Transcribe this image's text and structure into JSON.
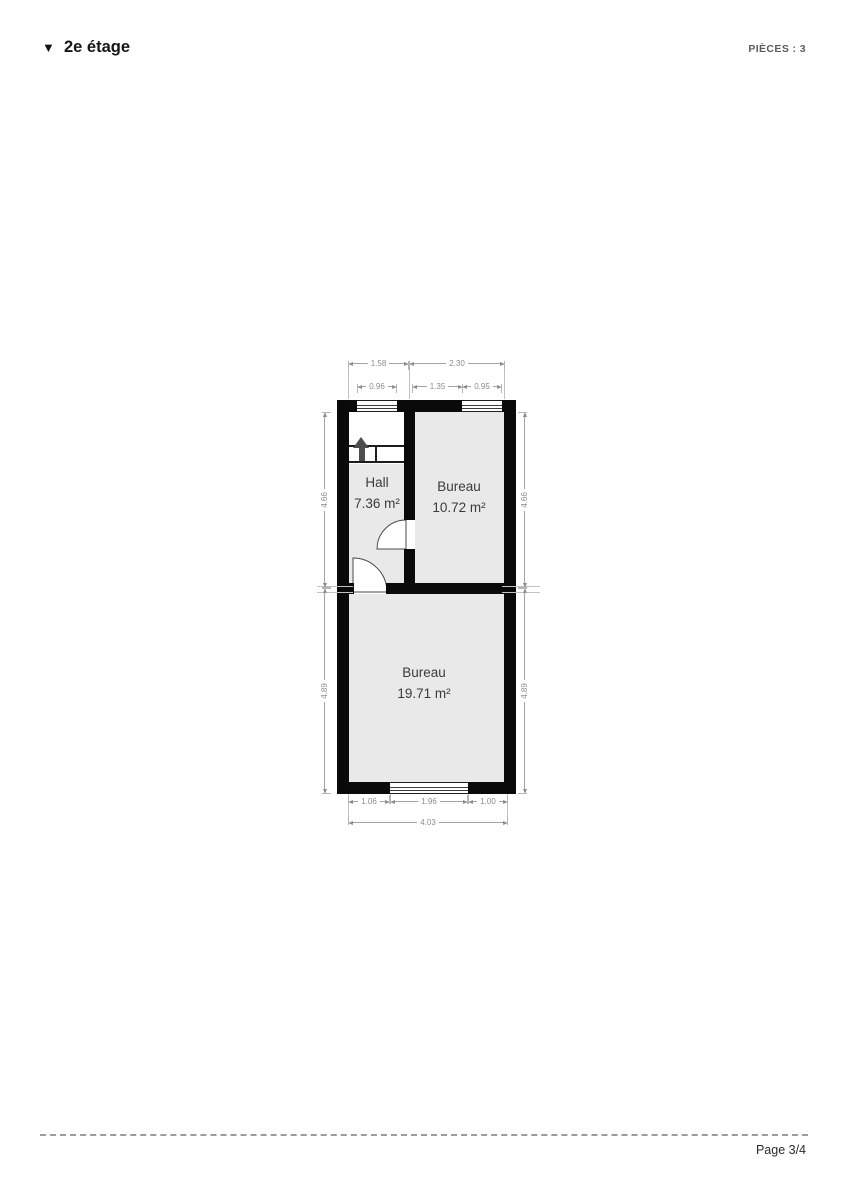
{
  "header": {
    "section_title": "2e étage",
    "pieces_label": "PIÈCES : 3"
  },
  "icons": {
    "section_collapse": "▼",
    "stairs_direction": "up-arrow"
  },
  "floorplan": {
    "rooms": [
      {
        "name": "Hall",
        "area": "7.36 m²"
      },
      {
        "name": "Bureau",
        "area": "10.72 m²"
      },
      {
        "name": "Bureau",
        "area": "19.71 m²"
      }
    ],
    "dimensions": {
      "top_outer": [
        "1.58",
        "2.30"
      ],
      "top_inner": [
        "0.96",
        "1.35",
        "0.95"
      ],
      "bottom_inner": [
        "1.06",
        "1.96",
        "1.00"
      ],
      "bottom_total": "4.03",
      "left": [
        "4.66",
        "4.89"
      ],
      "right": [
        "4.66",
        "4.89"
      ]
    }
  },
  "footer": {
    "page_label": "Page 3/4"
  }
}
